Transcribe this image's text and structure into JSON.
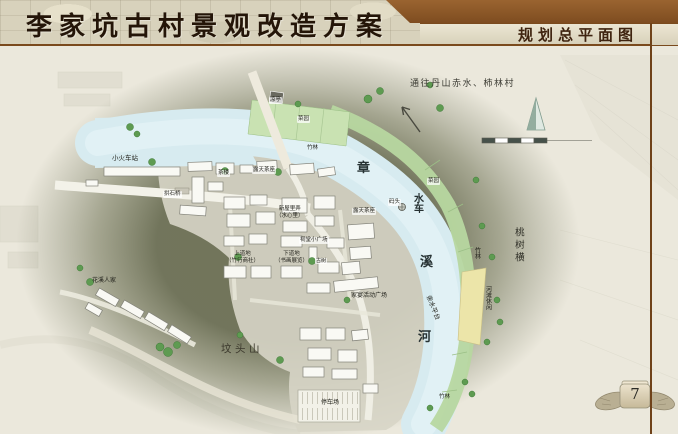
{
  "header": {
    "title": "李家坑古村景观改造方案",
    "section_title": "规划总平面图"
  },
  "page_number": "7",
  "map": {
    "labels": [
      {
        "text": "通往丹山赤水、柿林村"
      },
      {
        "text": "小火车站"
      },
      {
        "text": "凉亭"
      },
      {
        "text": "菜园"
      },
      {
        "text": "竹林"
      },
      {
        "text": "茶楼"
      },
      {
        "text": "露天茶座"
      },
      {
        "text": "拱石桥"
      },
      {
        "text": "章"
      },
      {
        "text": "水车"
      },
      {
        "text": "码头"
      },
      {
        "text": "露天茶座"
      },
      {
        "text": "菜园"
      },
      {
        "text": "溪"
      },
      {
        "text": "竹林"
      },
      {
        "text": "桃树横"
      },
      {
        "text": "河滩休闲"
      },
      {
        "text": "亲水平台"
      },
      {
        "text": "河"
      },
      {
        "text": "新屋里弄\n（水心里）"
      },
      {
        "text": "上道地\n（竹行商社）"
      },
      {
        "text": "下道地\n（书画展览）"
      },
      {
        "text": "祠堂小广场"
      },
      {
        "text": "古树"
      },
      {
        "text": "花溪人家"
      },
      {
        "text": "家宴活动广场"
      },
      {
        "text": "坟头山"
      },
      {
        "text": "停车场"
      },
      {
        "text": "竹林"
      }
    ]
  },
  "colors": {
    "header_brown": "#7a4a1d",
    "band_beige": "#e7e1cd",
    "map_bg": "#ebe8dc",
    "hill_olive": "#63674b",
    "river_blue": "#d7ebf0",
    "bank_green": "#b7d7a0",
    "strip_yellow": "#ece5a9",
    "building_fill": "#f9f9f4",
    "tree_green": "#5e9b51"
  }
}
